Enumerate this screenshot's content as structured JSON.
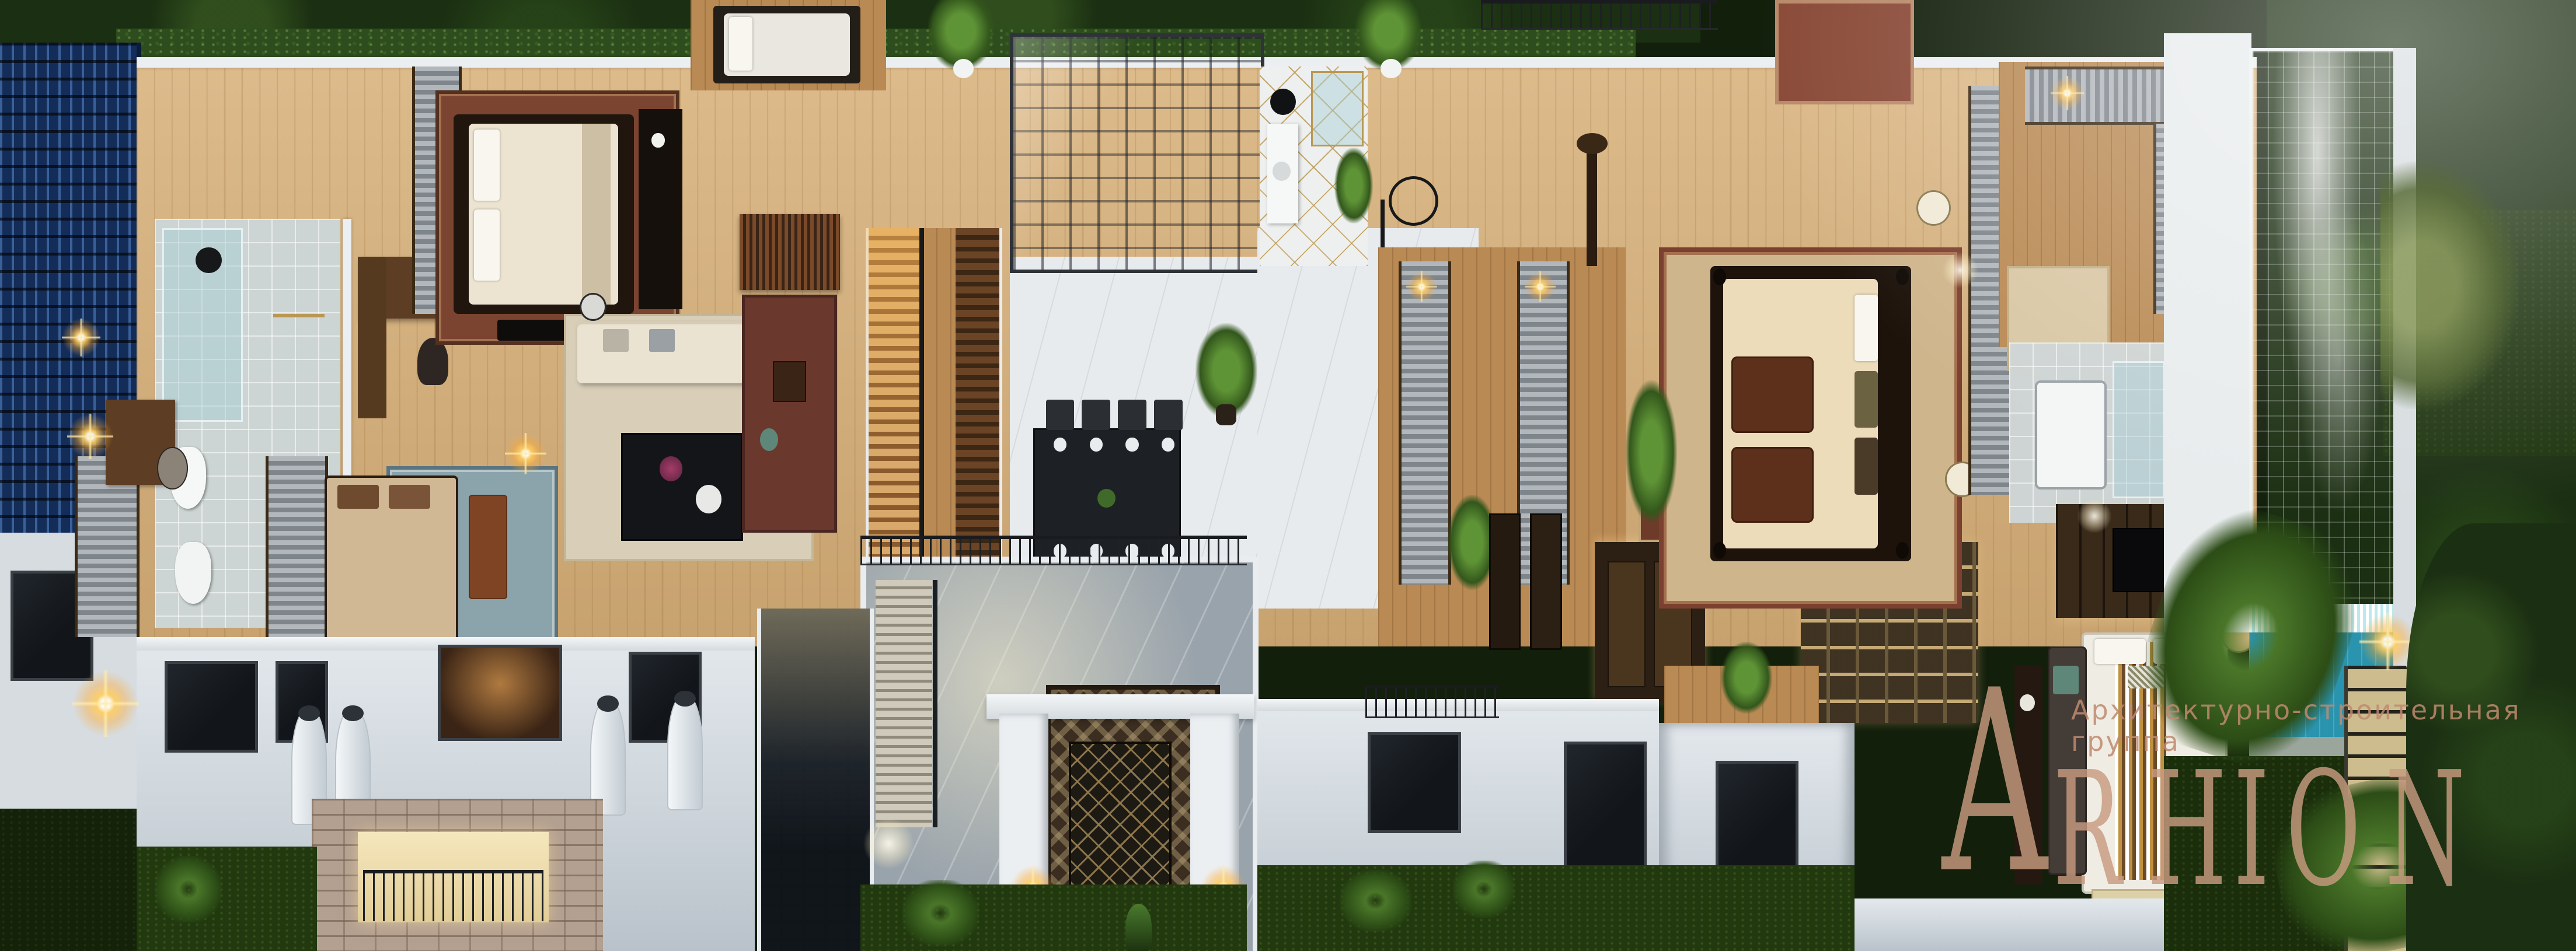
{
  "meta": {
    "render_type": "3d-architectural-cutaway-floorplan",
    "subject": "upper floor of a classical villa with pool and gardens, evening lighting"
  },
  "watermark": {
    "logo_letters": [
      "A",
      "R",
      "H",
      "I",
      "O",
      "N"
    ],
    "tagline": "Архитектурно-строительная группа",
    "logo_color": "#c89b80",
    "tagline_color": "#c08a6f"
  },
  "palette": {
    "wood_floor": "#d9b37e",
    "dark_wood": "#5d3e24",
    "interior_wall": "#eceff2",
    "facade": "#cdd5db",
    "atrium_marble": "#99a3ab",
    "pool_water": "#3fb9cd",
    "hedge_green": "#2e4d1e",
    "tree_green": "#1b2f12",
    "lawn_green": "#22390f",
    "neighbor_roof_blue": "#142f5c",
    "brick": "#b3a090",
    "warm_glow": "#ffcc66",
    "rug_red": "#7b4431",
    "rug_blue": "#8ba3ab",
    "gold_trim": "#b99753"
  },
  "scene": {
    "rooms": [
      "ensuite-bathroom-left",
      "dressing-desk-nook",
      "master-bedroom-left",
      "terrace-daybed",
      "sitting-lounge",
      "guest-bedroom-lower-left",
      "study-library",
      "staircase",
      "double-height-atrium",
      "dining-room-glass-roof",
      "marble-hall",
      "gold-marble-bathroom",
      "walk-in-closet-center",
      "four-poster-bedroom",
      "hallway-gallery",
      "guest-bedroom-lower-center",
      "walk-in-closet-right",
      "bathroom-right",
      "master-bedroom-pool-side",
      "swimming-pool",
      "garden-steps"
    ],
    "exterior": [
      "neighbor-blue-tile-roof",
      "boundary-hedge",
      "front-facade",
      "entrance-portal",
      "chimneys",
      "juliet-balconies",
      "brick-bay",
      "stair-window",
      "front-lawn",
      "palm-trees"
    ]
  }
}
